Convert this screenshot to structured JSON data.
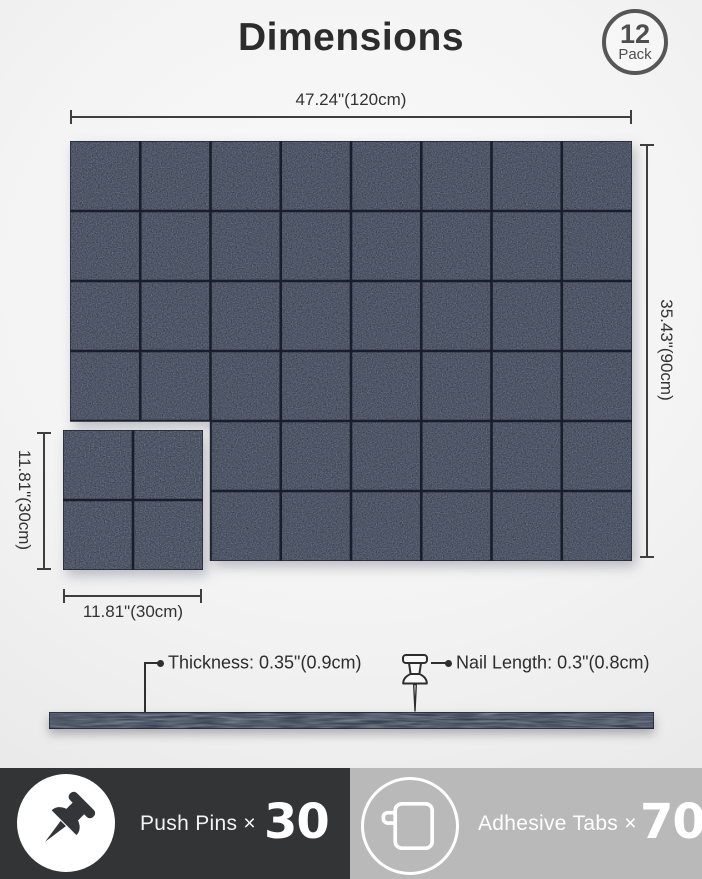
{
  "header": {
    "title": "Dimensions",
    "badge_count": "12",
    "badge_label": "Pack"
  },
  "dimensions": {
    "panel_width": "47.24\"(120cm)",
    "panel_height": "35.43\"(90cm)",
    "small_height": "11.81\"(30cm)",
    "small_width": "11.81\"(30cm)",
    "thickness": "Thickness: 0.35\"(0.9cm)",
    "nail_length": "Nail Length: 0.3\"(0.8cm)"
  },
  "panels": {
    "grid_cols": 8,
    "grid_rows": 6,
    "cutout_cols": 2,
    "cutout_rows": 2,
    "small_divisions": 2
  },
  "footer": {
    "push_pins_label": "Push Pins ×",
    "push_pins_count": "30",
    "adhesive_tabs_label": "Adhesive Tabs ×",
    "adhesive_tabs_count": "70"
  },
  "colors": {
    "felt_base": "#353d4f",
    "felt_seam": "#141926",
    "felt_edge": "#1d2331",
    "dim_line": "#3e3e3e",
    "footer_left_bg": "#323436",
    "footer_right_bg": "#b9b9b9"
  }
}
